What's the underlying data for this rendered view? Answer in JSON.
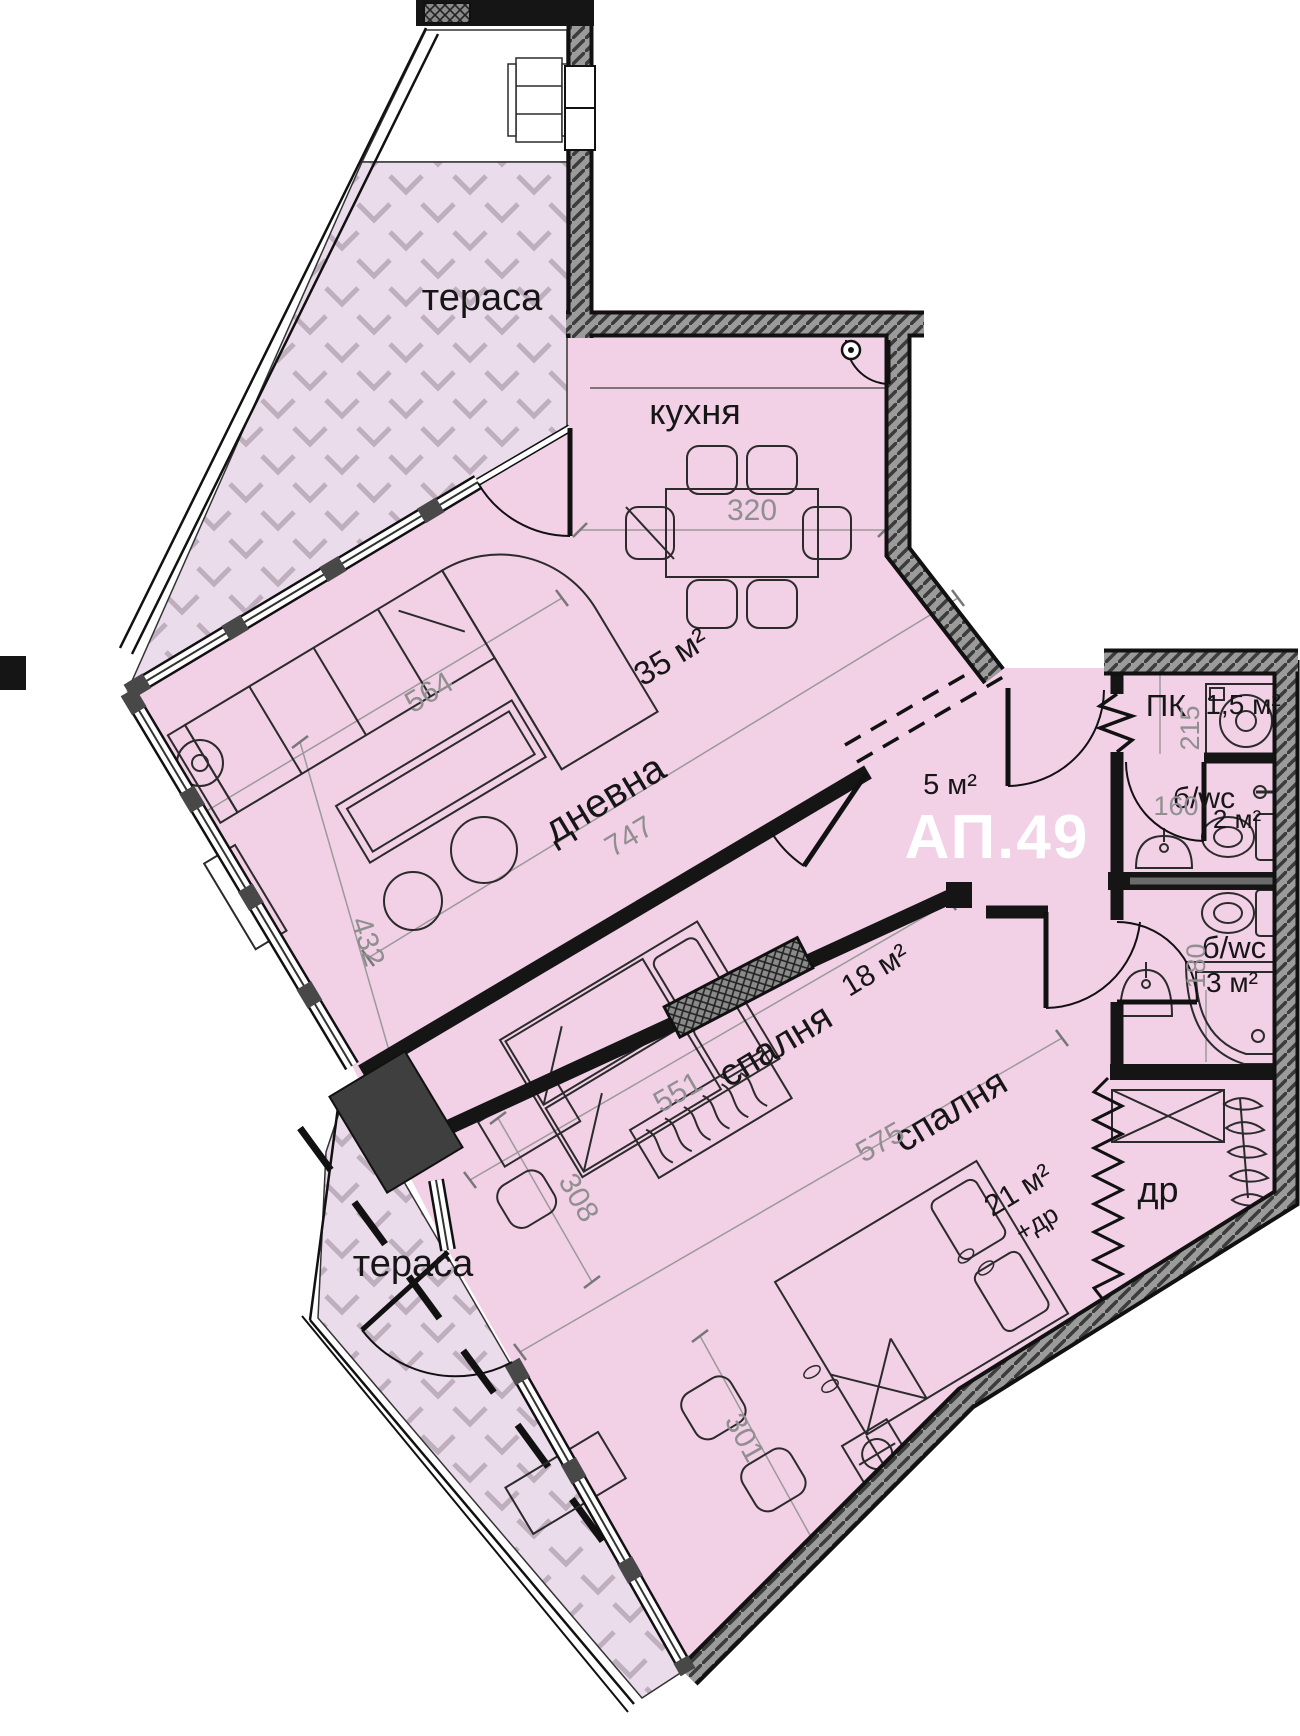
{
  "plan": {
    "apartment": "АП.49",
    "rooms": {
      "terrace_top": "тераса",
      "kitchen": "кухня",
      "living": "дневна",
      "living_area": "35 м²",
      "hall_area": "5 м²",
      "pk": "ПК",
      "pk_area": "1,5 м²",
      "bath1": "б/wc",
      "bath1_area": "2 м²",
      "bath2": "б/wc",
      "bath2_area": "3 м²",
      "bedroom1": "спалня",
      "bedroom1_area": "18 м²",
      "bedroom2": "спалня",
      "bedroom2_area": "21 м²",
      "bedroom2_extra": "+др",
      "closet": "др",
      "terrace_bottom": "тераса"
    },
    "dims": {
      "d320": "320",
      "d564": "564",
      "d747": "747",
      "d432": "432",
      "d551": "551",
      "d308": "308",
      "d575": "575",
      "d301": "301",
      "d215": "215",
      "d160": "160",
      "d180": "180"
    },
    "colors": {
      "room_fill": "#f2d0e6",
      "terrace_fill": "#eadcea",
      "wall_dark": "#151515",
      "wall_hatch": "#9b9b9b",
      "dim_text": "#8f8f8f",
      "apt_text": "#ffffff"
    }
  }
}
